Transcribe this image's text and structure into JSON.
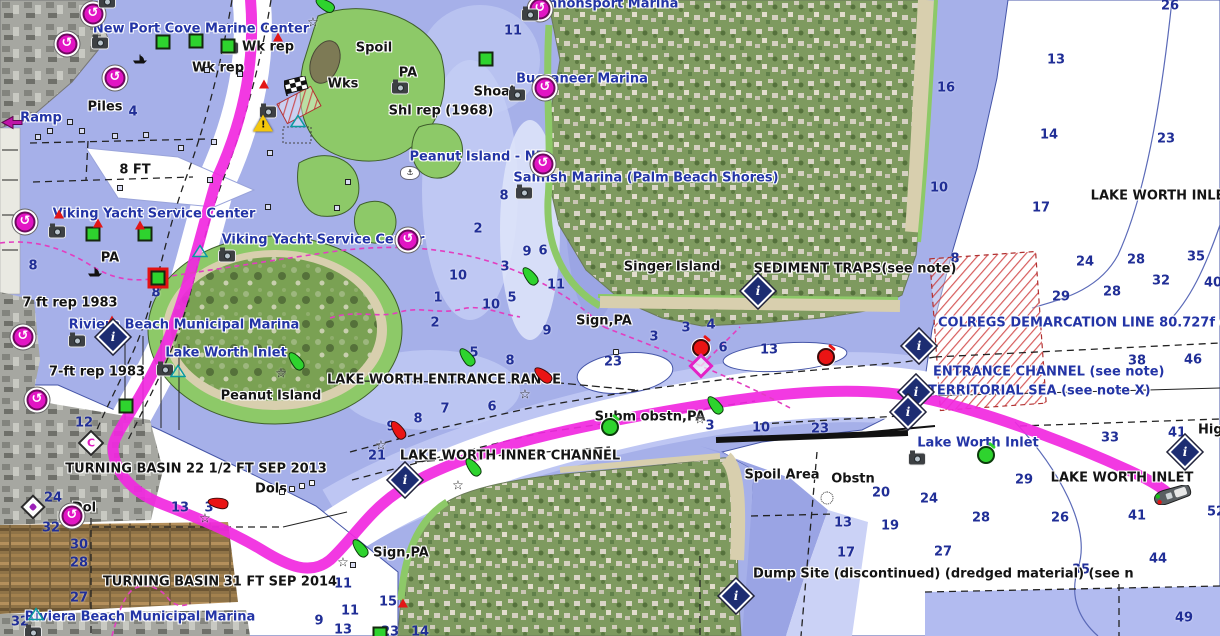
{
  "map": {
    "colors": {
      "water_shallow": "#a6b0e9",
      "water_mid": "#c5cef5",
      "water_pale": "#dde3fa",
      "water_deep": "#ffffff",
      "dump_area": "#b2bbf0",
      "land_green": "#8dc968",
      "beach": "#d8cfae",
      "route": "#f128e0",
      "track": "#e23ec0",
      "poi": "#e215c4",
      "navy_text": "#2334a6",
      "black_text": "#141414",
      "depth_text": "#202e96",
      "buoy_green": "#2ed32e",
      "buoy_red": "#ea1414",
      "info_diamond": "#1d2d72",
      "caution_yellow": "#f4c70c"
    },
    "labels": [
      {
        "t": "New Port Cove Marine Center",
        "x": 201,
        "y": 29,
        "c": "b"
      },
      {
        "t": "Cannonsport Marina",
        "x": 604,
        "y": 4,
        "c": "b"
      },
      {
        "t": "Buccaneer Marina",
        "x": 582,
        "y": 79,
        "c": "b"
      },
      {
        "t": "Sailfish Marina (Palm Beach Shores)",
        "x": 646,
        "y": 178,
        "c": "b"
      },
      {
        "t": "Peanut Island - NE",
        "x": 477,
        "y": 157,
        "c": "b"
      },
      {
        "t": "Viking Yacht Service Center",
        "x": 154,
        "y": 214,
        "c": "b"
      },
      {
        "t": "Viking Yacht Service Center",
        "x": 323,
        "y": 240,
        "c": "b"
      },
      {
        "t": "Riviera Beach Municipal Marina",
        "x": 184,
        "y": 325,
        "c": "b"
      },
      {
        "t": "Lake Worth Inlet",
        "x": 226,
        "y": 353,
        "c": "b"
      },
      {
        "t": "Lake Worth Inlet",
        "x": 978,
        "y": 443,
        "c": "b"
      },
      {
        "t": "Riviera Beach Municipal Marina",
        "x": 140,
        "y": 617,
        "c": "b"
      },
      {
        "t": "Ramp",
        "x": 41,
        "y": 118,
        "c": "b"
      },
      {
        "t": "COLREGS DEMARCATION LINE 80.727f (see note",
        "x": 938,
        "y": 323,
        "c": "b",
        "a": "l"
      },
      {
        "t": "ENTRANCE CHANNEL (see note)",
        "x": 933,
        "y": 372,
        "c": "b",
        "a": "l"
      },
      {
        "t": "TERRITORIAL SEA (see note X)",
        "x": 928,
        "y": 391,
        "c": "b",
        "a": "l"
      },
      {
        "t": "Wk rep",
        "x": 268,
        "y": 47,
        "c": "k"
      },
      {
        "t": "Wk rep",
        "x": 218,
        "y": 68,
        "c": "k"
      },
      {
        "t": "Piles",
        "x": 105,
        "y": 107,
        "c": "k"
      },
      {
        "t": "8 FT",
        "x": 135,
        "y": 170,
        "c": "k"
      },
      {
        "t": "Spoil",
        "x": 374,
        "y": 48,
        "c": "k"
      },
      {
        "t": "Wks",
        "x": 343,
        "y": 84,
        "c": "k"
      },
      {
        "t": "PA",
        "x": 408,
        "y": 73,
        "c": "k"
      },
      {
        "t": "Shoal",
        "x": 494,
        "y": 92,
        "c": "k"
      },
      {
        "t": "Shl rep (1968)",
        "x": 441,
        "y": 111,
        "c": "k"
      },
      {
        "t": "PA",
        "x": 110,
        "y": 258,
        "c": "k"
      },
      {
        "t": "7 ft rep 1983",
        "x": 70,
        "y": 303,
        "c": "k"
      },
      {
        "t": "7-ft rep 1983",
        "x": 97,
        "y": 372,
        "c": "k"
      },
      {
        "t": "Peanut Island",
        "x": 271,
        "y": 396,
        "c": "k"
      },
      {
        "t": "Singer Island",
        "x": 672,
        "y": 267,
        "c": "k"
      },
      {
        "t": "SEDIMENT TRAPS(see note)",
        "x": 855,
        "y": 269,
        "c": "k"
      },
      {
        "t": "LAKE WORTH INLET",
        "x": 1162,
        "y": 196,
        "c": "k"
      },
      {
        "t": "LAKE WORTH ENTRANCE RANGE",
        "x": 444,
        "y": 380,
        "c": "k"
      },
      {
        "t": "Sign,PA",
        "x": 604,
        "y": 321,
        "c": "k"
      },
      {
        "t": "LAKE WORTH INNER CHANNEL",
        "x": 510,
        "y": 456,
        "c": "k"
      },
      {
        "t": "Subm obstn,PA",
        "x": 650,
        "y": 417,
        "c": "k"
      },
      {
        "t": "TURNING BASIN 22 1/2 FT SEP 2013",
        "x": 196,
        "y": 469,
        "c": "k"
      },
      {
        "t": "Dols",
        "x": 271,
        "y": 489,
        "c": "k"
      },
      {
        "t": "Dol",
        "x": 84,
        "y": 508,
        "c": "k"
      },
      {
        "t": "TURNING BASIN 31 FT SEP 2014",
        "x": 220,
        "y": 582,
        "c": "k"
      },
      {
        "t": "Sign,PA",
        "x": 401,
        "y": 553,
        "c": "k"
      },
      {
        "t": "Spoil Area",
        "x": 782,
        "y": 475,
        "c": "k"
      },
      {
        "t": "Obstn",
        "x": 853,
        "y": 479,
        "c": "k"
      },
      {
        "t": "Dump Site (discontinued) (dredged material) (see n",
        "x": 753,
        "y": 574,
        "c": "k",
        "a": "l"
      },
      {
        "t": "LAKE WORTH INLET",
        "x": 1122,
        "y": 478,
        "c": "k"
      },
      {
        "t": "Hig",
        "x": 1198,
        "y": 430,
        "c": "k",
        "a": "l"
      }
    ],
    "depths": [
      {
        "v": "4",
        "x": 133,
        "y": 112
      },
      {
        "v": "11",
        "x": 513,
        "y": 31
      },
      {
        "v": "26",
        "x": 1170,
        "y": 6
      },
      {
        "v": "13",
        "x": 1056,
        "y": 60
      },
      {
        "v": "16",
        "x": 946,
        "y": 88
      },
      {
        "v": "14",
        "x": 1049,
        "y": 135
      },
      {
        "v": "23",
        "x": 1166,
        "y": 139
      },
      {
        "v": "10",
        "x": 939,
        "y": 188
      },
      {
        "v": "17",
        "x": 1041,
        "y": 208
      },
      {
        "v": "8",
        "x": 504,
        "y": 196
      },
      {
        "v": "2",
        "x": 478,
        "y": 229
      },
      {
        "v": "9",
        "x": 527,
        "y": 252
      },
      {
        "v": "6",
        "x": 543,
        "y": 251
      },
      {
        "v": "3",
        "x": 505,
        "y": 267
      },
      {
        "v": "10",
        "x": 458,
        "y": 276
      },
      {
        "v": "11",
        "x": 556,
        "y": 285
      },
      {
        "v": "1",
        "x": 438,
        "y": 298
      },
      {
        "v": "5",
        "x": 512,
        "y": 298
      },
      {
        "v": "10",
        "x": 491,
        "y": 305
      },
      {
        "v": "2",
        "x": 435,
        "y": 323
      },
      {
        "v": "9",
        "x": 547,
        "y": 331
      },
      {
        "v": "8",
        "x": 33,
        "y": 266
      },
      {
        "v": "8",
        "x": 156,
        "y": 293
      },
      {
        "v": "3",
        "x": 654,
        "y": 337
      },
      {
        "v": "3",
        "x": 686,
        "y": 328
      },
      {
        "v": "4",
        "x": 711,
        "y": 325
      },
      {
        "v": "6",
        "x": 723,
        "y": 348
      },
      {
        "v": "13",
        "x": 769,
        "y": 350
      },
      {
        "v": "23",
        "x": 613,
        "y": 362
      },
      {
        "v": "5",
        "x": 474,
        "y": 353
      },
      {
        "v": "8",
        "x": 510,
        "y": 361
      },
      {
        "v": "7",
        "x": 445,
        "y": 409
      },
      {
        "v": "6",
        "x": 492,
        "y": 407
      },
      {
        "v": "8",
        "x": 418,
        "y": 419
      },
      {
        "v": "9",
        "x": 391,
        "y": 427
      },
      {
        "v": "21",
        "x": 377,
        "y": 456
      },
      {
        "v": "3",
        "x": 710,
        "y": 426
      },
      {
        "v": "12",
        "x": 84,
        "y": 423
      },
      {
        "v": "24",
        "x": 53,
        "y": 498
      },
      {
        "v": "32",
        "x": 51,
        "y": 528
      },
      {
        "v": "13",
        "x": 180,
        "y": 508
      },
      {
        "v": "3",
        "x": 209,
        "y": 508
      },
      {
        "v": "30",
        "x": 79,
        "y": 545
      },
      {
        "v": "28",
        "x": 79,
        "y": 563
      },
      {
        "v": "27",
        "x": 79,
        "y": 598
      },
      {
        "v": "32",
        "x": 20,
        "y": 622
      },
      {
        "v": "9",
        "x": 319,
        "y": 621
      },
      {
        "v": "11",
        "x": 343,
        "y": 584
      },
      {
        "v": "15",
        "x": 388,
        "y": 602
      },
      {
        "v": "11",
        "x": 350,
        "y": 611
      },
      {
        "v": "13",
        "x": 343,
        "y": 630
      },
      {
        "v": "23",
        "x": 390,
        "y": 632
      },
      {
        "v": "14",
        "x": 420,
        "y": 632
      },
      {
        "v": "10",
        "x": 761,
        "y": 428
      },
      {
        "v": "23",
        "x": 820,
        "y": 429
      },
      {
        "v": "20",
        "x": 881,
        "y": 493
      },
      {
        "v": "24",
        "x": 929,
        "y": 499
      },
      {
        "v": "28",
        "x": 981,
        "y": 518
      },
      {
        "v": "13",
        "x": 843,
        "y": 523
      },
      {
        "v": "19",
        "x": 890,
        "y": 526
      },
      {
        "v": "17",
        "x": 846,
        "y": 553
      },
      {
        "v": "27",
        "x": 943,
        "y": 552
      },
      {
        "v": "29",
        "x": 1024,
        "y": 480
      },
      {
        "v": "8",
        "x": 955,
        "y": 259
      },
      {
        "v": "24",
        "x": 1085,
        "y": 262
      },
      {
        "v": "28",
        "x": 1136,
        "y": 260
      },
      {
        "v": "35",
        "x": 1196,
        "y": 257
      },
      {
        "v": "32",
        "x": 1161,
        "y": 281
      },
      {
        "v": "40",
        "x": 1213,
        "y": 283
      },
      {
        "v": "29",
        "x": 1061,
        "y": 297
      },
      {
        "v": "28",
        "x": 1112,
        "y": 292
      },
      {
        "v": "38",
        "x": 1137,
        "y": 361
      },
      {
        "v": "46",
        "x": 1193,
        "y": 360
      },
      {
        "v": "33",
        "x": 1110,
        "y": 438
      },
      {
        "v": "41",
        "x": 1177,
        "y": 433
      },
      {
        "v": "26",
        "x": 1060,
        "y": 518
      },
      {
        "v": "41",
        "x": 1137,
        "y": 516
      },
      {
        "v": "52",
        "x": 1216,
        "y": 512
      },
      {
        "v": "44",
        "x": 1158,
        "y": 559
      },
      {
        "v": "35",
        "x": 1081,
        "y": 570
      },
      {
        "v": "49",
        "x": 1184,
        "y": 618
      }
    ],
    "markers": [
      {
        "k": "poi",
        "x": 93,
        "y": 14
      },
      {
        "k": "poi",
        "x": 67,
        "y": 44
      },
      {
        "k": "poi",
        "x": 115,
        "y": 78
      },
      {
        "k": "poi",
        "x": 540,
        "y": 9
      },
      {
        "k": "poi",
        "x": 545,
        "y": 88
      },
      {
        "k": "poi",
        "x": 543,
        "y": 164
      },
      {
        "k": "poi",
        "x": 408,
        "y": 240
      },
      {
        "k": "poi",
        "x": 25,
        "y": 222
      },
      {
        "k": "poi",
        "x": 23,
        "y": 337
      },
      {
        "k": "poi",
        "x": 37,
        "y": 400
      },
      {
        "k": "poi",
        "x": 72,
        "y": 516
      },
      {
        "k": "cam",
        "x": 107,
        "y": 2
      },
      {
        "k": "cam",
        "x": 100,
        "y": 43
      },
      {
        "k": "cam",
        "x": 230,
        "y": 48
      },
      {
        "k": "cam",
        "x": 530,
        "y": 15
      },
      {
        "k": "cam",
        "x": 517,
        "y": 95
      },
      {
        "k": "cam",
        "x": 400,
        "y": 88
      },
      {
        "k": "cam",
        "x": 268,
        "y": 112
      },
      {
        "k": "cam",
        "x": 524,
        "y": 193
      },
      {
        "k": "cam",
        "x": 57,
        "y": 232
      },
      {
        "k": "cam",
        "x": 227,
        "y": 256
      },
      {
        "k": "cam",
        "x": 77,
        "y": 341
      },
      {
        "k": "cam",
        "x": 165,
        "y": 370
      },
      {
        "k": "cam",
        "x": 917,
        "y": 459
      },
      {
        "k": "cam",
        "x": 33,
        "y": 633
      },
      {
        "k": "gsq",
        "x": 163,
        "y": 42
      },
      {
        "k": "gsq",
        "x": 196,
        "y": 41
      },
      {
        "k": "gsq",
        "x": 228,
        "y": 46
      },
      {
        "k": "gsq",
        "x": 486,
        "y": 59
      },
      {
        "k": "gsq",
        "x": 93,
        "y": 234
      },
      {
        "k": "gsq",
        "x": 145,
        "y": 234
      },
      {
        "k": "gsq",
        "x": 126,
        "y": 406
      },
      {
        "k": "gsq",
        "x": 380,
        "y": 634
      },
      {
        "k": "gsqsel",
        "x": 158,
        "y": 278
      },
      {
        "k": "rtri",
        "x": 278,
        "y": 37
      },
      {
        "k": "rtri",
        "x": 264,
        "y": 84
      },
      {
        "k": "rtri",
        "x": 59,
        "y": 214
      },
      {
        "k": "rtri",
        "x": 98,
        "y": 223
      },
      {
        "k": "rtri",
        "x": 140,
        "y": 225
      },
      {
        "k": "rtri",
        "x": 112,
        "y": 320
      },
      {
        "k": "rtri",
        "x": 403,
        "y": 603
      },
      {
        "k": "gbuoy",
        "x": 325,
        "y": 5,
        "r": -60
      },
      {
        "k": "gbuoy",
        "x": 296,
        "y": 361
      },
      {
        "k": "gbuoy",
        "x": 467,
        "y": 357
      },
      {
        "k": "gbuoy",
        "x": 530,
        "y": 276
      },
      {
        "k": "gbuoy",
        "x": 715,
        "y": 405
      },
      {
        "k": "gbuoy",
        "x": 473,
        "y": 467
      },
      {
        "k": "gbuoy",
        "x": 360,
        "y": 548
      },
      {
        "k": "glbuoy",
        "x": 986,
        "y": 455
      },
      {
        "k": "glbuoy",
        "x": 610,
        "y": 427
      },
      {
        "k": "rbuoy",
        "x": 218,
        "y": 503,
        "r": -80
      },
      {
        "k": "rbuoy",
        "x": 543,
        "y": 375,
        "r": -50
      },
      {
        "k": "rbuoy",
        "x": 398,
        "y": 430
      },
      {
        "k": "rlbuoy",
        "x": 701,
        "y": 348
      },
      {
        "k": "rlbuoy",
        "x": 826,
        "y": 357
      },
      {
        "k": "idia",
        "x": 758,
        "y": 291
      },
      {
        "k": "idia",
        "x": 919,
        "y": 346
      },
      {
        "k": "idia",
        "x": 916,
        "y": 392
      },
      {
        "k": "idia",
        "x": 908,
        "y": 412
      },
      {
        "k": "idia",
        "x": 113,
        "y": 337
      },
      {
        "k": "idia",
        "x": 405,
        "y": 480
      },
      {
        "k": "idia",
        "x": 736,
        "y": 596
      },
      {
        "k": "idia",
        "x": 1185,
        "y": 452
      },
      {
        "k": "mdia",
        "x": 701,
        "y": 366
      },
      {
        "k": "cdia",
        "x": 91,
        "y": 443
      },
      {
        "k": "pdia",
        "x": 33,
        "y": 507
      },
      {
        "k": "star",
        "x": 313,
        "y": 23
      },
      {
        "k": "star",
        "x": 281,
        "y": 374
      },
      {
        "k": "star",
        "x": 525,
        "y": 395
      },
      {
        "k": "star",
        "x": 381,
        "y": 446
      },
      {
        "k": "star",
        "x": 458,
        "y": 486
      },
      {
        "k": "star",
        "x": 343,
        "y": 563
      },
      {
        "k": "star",
        "x": 205,
        "y": 519
      },
      {
        "k": "star",
        "x": 700,
        "y": 420
      },
      {
        "k": "warn",
        "x": 263,
        "y": 123
      },
      {
        "k": "flag",
        "x": 297,
        "y": 88
      },
      {
        "k": "boat",
        "x": 1172,
        "y": 497
      },
      {
        "k": "sboat",
        "x": 140,
        "y": 59
      },
      {
        "k": "sboat",
        "x": 95,
        "y": 272
      },
      {
        "k": "wreck",
        "x": 410,
        "y": 173
      },
      {
        "k": "obstn",
        "x": 827,
        "y": 498
      },
      {
        "k": "ttri",
        "x": 298,
        "y": 122
      },
      {
        "k": "ttri",
        "x": 200,
        "y": 252
      },
      {
        "k": "ttri",
        "x": 178,
        "y": 372
      },
      {
        "k": "ttri",
        "x": 36,
        "y": 615
      },
      {
        "k": "rampi",
        "x": 12,
        "y": 124
      },
      {
        "k": "pile",
        "x": 70,
        "y": 122
      },
      {
        "k": "pile",
        "x": 50,
        "y": 131
      },
      {
        "k": "pile",
        "x": 38,
        "y": 137
      },
      {
        "k": "pile",
        "x": 82,
        "y": 131
      },
      {
        "k": "pile",
        "x": 115,
        "y": 136
      },
      {
        "k": "pile",
        "x": 146,
        "y": 135
      },
      {
        "k": "pile",
        "x": 181,
        "y": 148
      },
      {
        "k": "pile",
        "x": 214,
        "y": 142
      },
      {
        "k": "pile",
        "x": 270,
        "y": 153
      },
      {
        "k": "pile",
        "x": 207,
        "y": 70
      },
      {
        "k": "pile",
        "x": 240,
        "y": 74
      },
      {
        "k": "pile",
        "x": 348,
        "y": 182
      },
      {
        "k": "pile",
        "x": 210,
        "y": 180
      },
      {
        "k": "pile",
        "x": 120,
        "y": 188
      },
      {
        "k": "pile",
        "x": 268,
        "y": 207
      },
      {
        "k": "pile",
        "x": 353,
        "y": 565
      },
      {
        "k": "pile",
        "x": 337,
        "y": 208
      },
      {
        "k": "dol",
        "x": 282,
        "y": 492
      },
      {
        "k": "dol",
        "x": 292,
        "y": 489
      },
      {
        "k": "dol",
        "x": 302,
        "y": 486
      },
      {
        "k": "dol",
        "x": 312,
        "y": 483
      },
      {
        "k": "dol",
        "x": 616,
        "y": 352
      }
    ]
  }
}
